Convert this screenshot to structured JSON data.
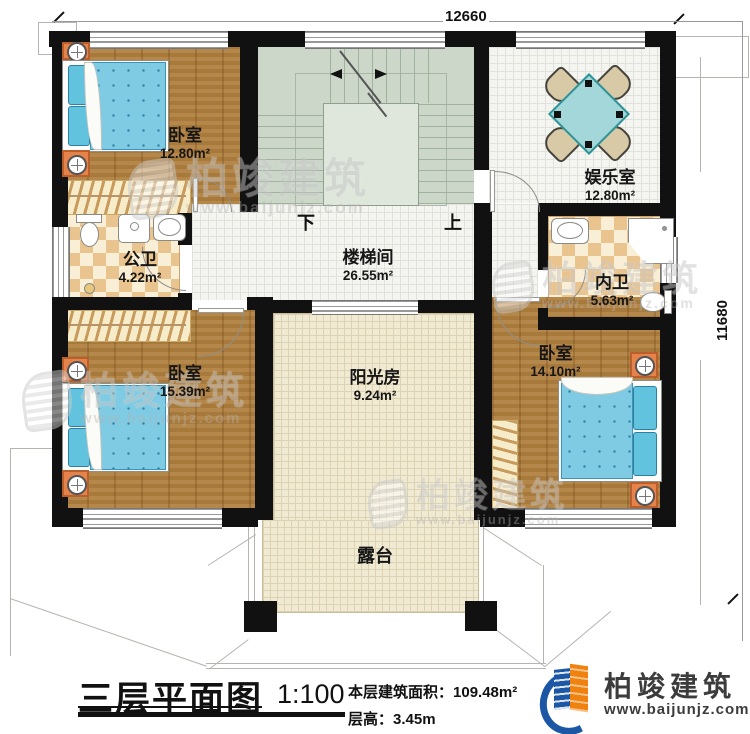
{
  "dimensions": {
    "top": "12660",
    "right": "11680"
  },
  "rooms": {
    "bedroom_tl": {
      "name": "卧室",
      "area": "12.80m²"
    },
    "entertainment": {
      "name": "娱乐室",
      "area": "12.80m²"
    },
    "public_bath": {
      "name": "公卫",
      "area": "4.22m²"
    },
    "stairwell": {
      "name": "楼梯间",
      "area": "26.55m²"
    },
    "ensuite_bath": {
      "name": "内卫",
      "area": "5.63m²"
    },
    "bedroom_bl": {
      "name": "卧室",
      "area": "15.39m²"
    },
    "sunroom": {
      "name": "阳光房",
      "area": "9.24m²"
    },
    "bedroom_br": {
      "name": "卧室",
      "area": "14.10m²"
    },
    "terrace": {
      "name": "露台"
    }
  },
  "stairs": {
    "down": "下",
    "up": "上"
  },
  "title_block": {
    "title": "三层平面图",
    "scale": "1:100",
    "area_label": "本层建筑面积：",
    "area_value": "109.48m²",
    "height_label": "层高：",
    "height_value": "3.45m"
  },
  "brand": {
    "name": "柏竣建筑",
    "url": "www.baijunjz.com"
  },
  "watermark": {
    "name": "柏竣建筑",
    "url": "www.baijunjz.com"
  },
  "colors": {
    "wall": "#111111",
    "wood": "#b0803f",
    "checker_tan": "#eac48e",
    "stair_green": "#ccd7ca",
    "beige": "#f1ead3",
    "mattress_blue": "#7fcbe3",
    "table_teal": "#a4d7d9",
    "brand_blue": "#1c57a5",
    "brand_orange": "#f0820f"
  }
}
